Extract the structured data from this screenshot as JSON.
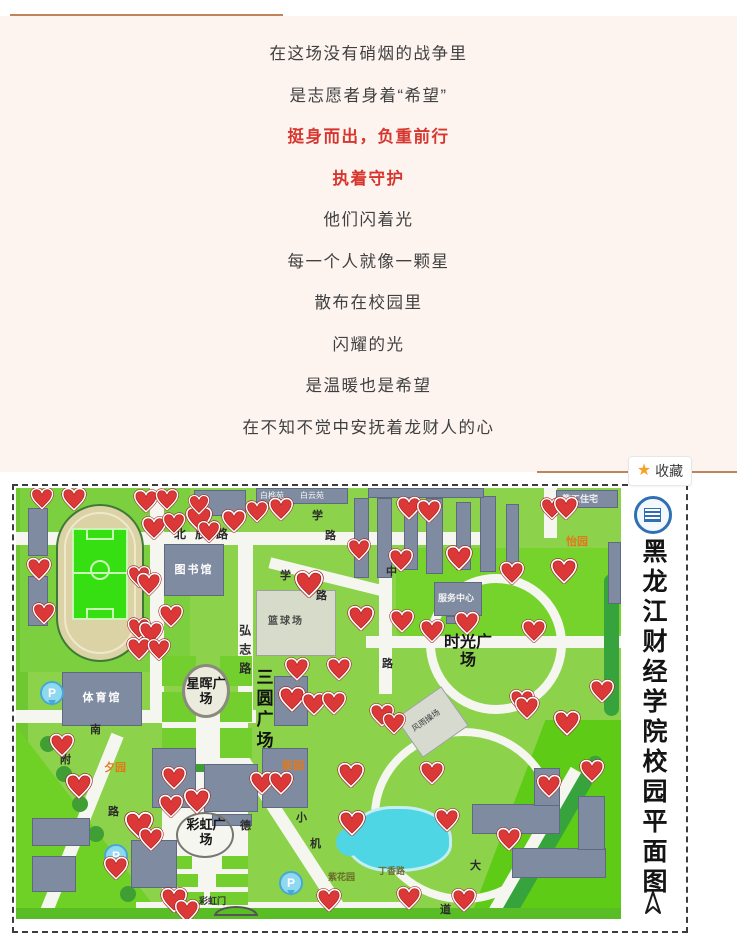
{
  "colors": {
    "divider": "#c0845c",
    "poem_red": "#d7362e",
    "star": "#f5a229",
    "heart": "#dc3838",
    "map_green": "#8cd24a",
    "pond": "#4fd6e4"
  },
  "poem": {
    "lines": [
      {
        "text": "在这场没有硝烟的战争里",
        "red": false
      },
      {
        "text": "是志愿者身着“希望”",
        "red": false
      },
      {
        "text": "挺身而出，负重前行",
        "red": true
      },
      {
        "text": "执着守护",
        "red": true
      },
      {
        "text": "他们闪着光",
        "red": false
      },
      {
        "text": "每一个人就像一颗星",
        "red": false
      },
      {
        "text": "散布在校园里",
        "red": false
      },
      {
        "text": "闪耀的光",
        "red": false
      },
      {
        "text": "是温暖也是希望",
        "red": false
      },
      {
        "text": "在不知不觉中安抚着龙财人的心",
        "red": false
      }
    ]
  },
  "favorite": {
    "star_icon": "★",
    "label": "收藏"
  },
  "map": {
    "title": "黑龙江财经学院校园平面图",
    "parking_label": "P",
    "labels": [
      {
        "text": "北辰路",
        "x": 158,
        "y": 40,
        "cls": "road-h"
      },
      {
        "text": "学",
        "x": 296,
        "y": 22,
        "cls": "road-ch"
      },
      {
        "text": "路",
        "x": 309,
        "y": 42,
        "cls": "road-ch"
      },
      {
        "text": "学",
        "x": 264,
        "y": 82,
        "cls": "road-ch"
      },
      {
        "text": "路",
        "x": 300,
        "y": 102,
        "cls": "road-ch"
      },
      {
        "text": "中",
        "x": 370,
        "y": 78,
        "cls": "road-ch"
      },
      {
        "text": "路",
        "x": 366,
        "y": 170,
        "cls": "road-ch"
      },
      {
        "text": "弘志路",
        "x": 221,
        "y": 136,
        "cls": "road-v"
      },
      {
        "text": "三圆广场",
        "x": 237,
        "y": 180,
        "cls": "plaza-v"
      },
      {
        "text": "星晖广场",
        "x": 166,
        "y": 189,
        "cls": "plaza-round"
      },
      {
        "text": "时光广场",
        "x": 428,
        "y": 146,
        "cls": "plaza-big"
      },
      {
        "text": "彩虹广场",
        "x": 166,
        "y": 330,
        "cls": "plaza-round"
      },
      {
        "text": "图书馆",
        "x": 150,
        "y": 76,
        "cls": "bldg-label",
        "w": 56
      },
      {
        "text": "体育馆",
        "x": 50,
        "y": 204,
        "cls": "bldg-label",
        "w": 72
      },
      {
        "text": "教工住宅",
        "x": 546,
        "y": 6,
        "cls": "bldg-sm"
      },
      {
        "text": "服务中心",
        "x": 422,
        "y": 105,
        "cls": "bldg-sm"
      },
      {
        "text": "篮球场",
        "x": 252,
        "y": 128,
        "cls": "court-label",
        "w": 56
      },
      {
        "text": "风雨操场",
        "x": 394,
        "y": 228,
        "cls": "court-sm"
      },
      {
        "text": "白桦苑",
        "x": 244,
        "y": 3,
        "cls": "tiny-bldg"
      },
      {
        "text": "白云苑",
        "x": 284,
        "y": 3,
        "cls": "tiny-bldg"
      },
      {
        "text": "怡园",
        "x": 550,
        "y": 48,
        "cls": "garden-orange"
      },
      {
        "text": "夕园",
        "x": 88,
        "y": 274,
        "cls": "garden-orange"
      },
      {
        "text": "新园",
        "x": 266,
        "y": 272,
        "cls": "garden-orange"
      },
      {
        "text": "彩虹门",
        "x": 183,
        "y": 408,
        "cls": "tiny-dark"
      },
      {
        "text": "丁香路",
        "x": 362,
        "y": 378,
        "cls": "garden-olive"
      },
      {
        "text": "紫花园",
        "x": 312,
        "y": 384,
        "cls": "garden-olive"
      },
      {
        "text": "南",
        "x": 74,
        "y": 236,
        "cls": "road-ch"
      },
      {
        "text": "路",
        "x": 92,
        "y": 318,
        "cls": "road-ch"
      },
      {
        "text": "附",
        "x": 44,
        "y": 266,
        "cls": "road-ch"
      },
      {
        "text": "德",
        "x": 224,
        "y": 332,
        "cls": "road-ch"
      },
      {
        "text": "小",
        "x": 280,
        "y": 324,
        "cls": "road-ch"
      },
      {
        "text": "机",
        "x": 294,
        "y": 350,
        "cls": "road-ch"
      },
      {
        "text": "大",
        "x": 454,
        "y": 372,
        "cls": "road-ch"
      },
      {
        "text": "道",
        "x": 424,
        "y": 416,
        "cls": "road-ch"
      }
    ],
    "hearts": [
      [
        26,
        11,
        24
      ],
      [
        58,
        12,
        26
      ],
      [
        130,
        14,
        26
      ],
      [
        151,
        12,
        24
      ],
      [
        138,
        41,
        26
      ],
      [
        158,
        36,
        24
      ],
      [
        183,
        32,
        28
      ],
      [
        193,
        44,
        24
      ],
      [
        183,
        17,
        22
      ],
      [
        218,
        34,
        26
      ],
      [
        241,
        24,
        24
      ],
      [
        265,
        22,
        26
      ],
      [
        23,
        82,
        26
      ],
      [
        28,
        126,
        24
      ],
      [
        123,
        89,
        24
      ],
      [
        133,
        97,
        26
      ],
      [
        155,
        129,
        26
      ],
      [
        123,
        141,
        24
      ],
      [
        135,
        146,
        26
      ],
      [
        123,
        162,
        26
      ],
      [
        143,
        162,
        24
      ],
      [
        293,
        97,
        30
      ],
      [
        343,
        62,
        24
      ],
      [
        345,
        131,
        28
      ],
      [
        281,
        182,
        26
      ],
      [
        323,
        182,
        26
      ],
      [
        276,
        212,
        28
      ],
      [
        298,
        217,
        26
      ],
      [
        318,
        216,
        26
      ],
      [
        393,
        21,
        26
      ],
      [
        413,
        24,
        26
      ],
      [
        536,
        21,
        24
      ],
      [
        550,
        21,
        26
      ],
      [
        443,
        71,
        28
      ],
      [
        385,
        73,
        26
      ],
      [
        496,
        86,
        26
      ],
      [
        548,
        84,
        28
      ],
      [
        451,
        136,
        26
      ],
      [
        386,
        134,
        26
      ],
      [
        416,
        144,
        26
      ],
      [
        518,
        144,
        26
      ],
      [
        586,
        204,
        26
      ],
      [
        506,
        214,
        26
      ],
      [
        46,
        258,
        26
      ],
      [
        63,
        299,
        28
      ],
      [
        158,
        291,
        26
      ],
      [
        181,
        314,
        28
      ],
      [
        155,
        319,
        26
      ],
      [
        123,
        338,
        30
      ],
      [
        135,
        352,
        26
      ],
      [
        246,
        296,
        26
      ],
      [
        265,
        296,
        26
      ],
      [
        335,
        288,
        28
      ],
      [
        336,
        336,
        28
      ],
      [
        100,
        381,
        26
      ],
      [
        158,
        413,
        28
      ],
      [
        171,
        424,
        26
      ],
      [
        313,
        413,
        26
      ],
      [
        366,
        228,
        26
      ],
      [
        378,
        236,
        24
      ],
      [
        511,
        221,
        26
      ],
      [
        551,
        236,
        28
      ],
      [
        416,
        286,
        26
      ],
      [
        576,
        284,
        26
      ],
      [
        533,
        299,
        26
      ],
      [
        431,
        333,
        26
      ],
      [
        493,
        352,
        26
      ],
      [
        393,
        411,
        26
      ],
      [
        448,
        413,
        26
      ]
    ],
    "parking": [
      [
        34,
        207
      ],
      [
        98,
        370
      ],
      [
        273,
        397
      ]
    ]
  }
}
